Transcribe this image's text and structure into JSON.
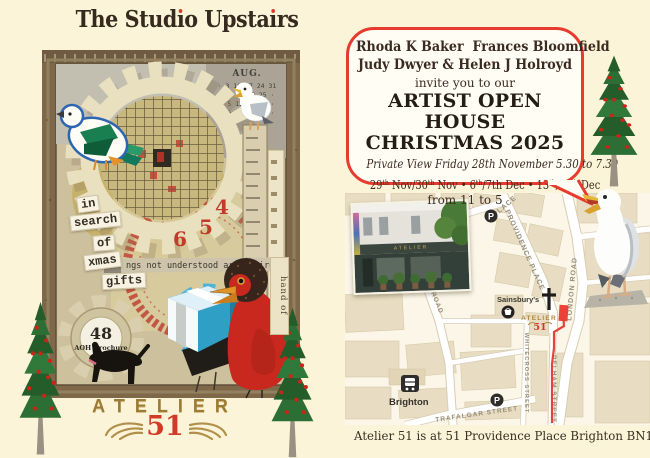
{
  "colors": {
    "accent_red": "#e23a2c",
    "gold": "#9c7b35",
    "cream_background": "#fbf4d8",
    "map_block_beige": "#e8ddc2"
  },
  "left": {
    "title": {
      "parts": [
        {
          "t": "The Stud"
        },
        {
          "i": "ı"
        },
        {
          "t": "o Upsta"
        },
        {
          "i": "ı"
        },
        {
          "t": "rs"
        }
      ]
    },
    "calendar": {
      "month": "AUG.",
      "rows": [
        "· 3 10 17 24 31",
        "· 4 11 18 25 ·",
        "· 5 12 19 26 ·",
        "· 6 13 20 27 ·"
      ]
    },
    "clock": {
      "n4": "4",
      "n5": "5",
      "n6": "6"
    },
    "chips": {
      "c0": "in",
      "c1": "search",
      "c2": "of",
      "c3": "xmas",
      "c4": "gifts"
    },
    "typewriter": "ngs not understood are admired",
    "badge": {
      "number": "48",
      "label": "AOH Brochure"
    },
    "hand_strip": "hand of",
    "logo": {
      "name": "ATELIER",
      "number": "51"
    }
  },
  "right": {
    "bubble": {
      "names1": "Rhoda K Baker  Frances Bloomfield",
      "names2": "Judy Dwyer & Helen J Holroyd",
      "invite": "invite you to our",
      "event1": "ARTIST OPEN HOUSE",
      "event2": "CHRISTMAS 2025",
      "private_view": "Private View Friday 28th November 5.30 to 7.30",
      "dates": {
        "parts": [
          {
            "t": "29"
          },
          {
            "sup": "th"
          },
          {
            "t": " Nov/30"
          },
          {
            "sup": "th"
          },
          {
            "t": " Nov • 6"
          },
          {
            "sup": "th"
          },
          {
            "t": "/7th Dec • 13"
          },
          {
            "sup": "th"
          },
          {
            "t": "/14"
          },
          {
            "sup": "th"
          },
          {
            "t": " Dec"
          }
        ]
      },
      "hours": "from 11 to 5"
    },
    "map": {
      "streets": {
        "place": "PLACE",
        "providence": "PROVIDENCE PLACE",
        "london": "LONDON ROAD",
        "ley": "LEY ROAD",
        "whitecross": "WHITECROSS STREET",
        "pelham": "PELHAM STREET",
        "trafalgar": "TRAFALGAR STREET"
      },
      "sainsburys": "Sainsbury's",
      "station": "Brighton",
      "parking": "P",
      "atelier": {
        "name": "ATELIER",
        "number": "51"
      }
    },
    "address": "Atelier 51 is at 51 Providence Place Brighton BN1 4GE"
  }
}
